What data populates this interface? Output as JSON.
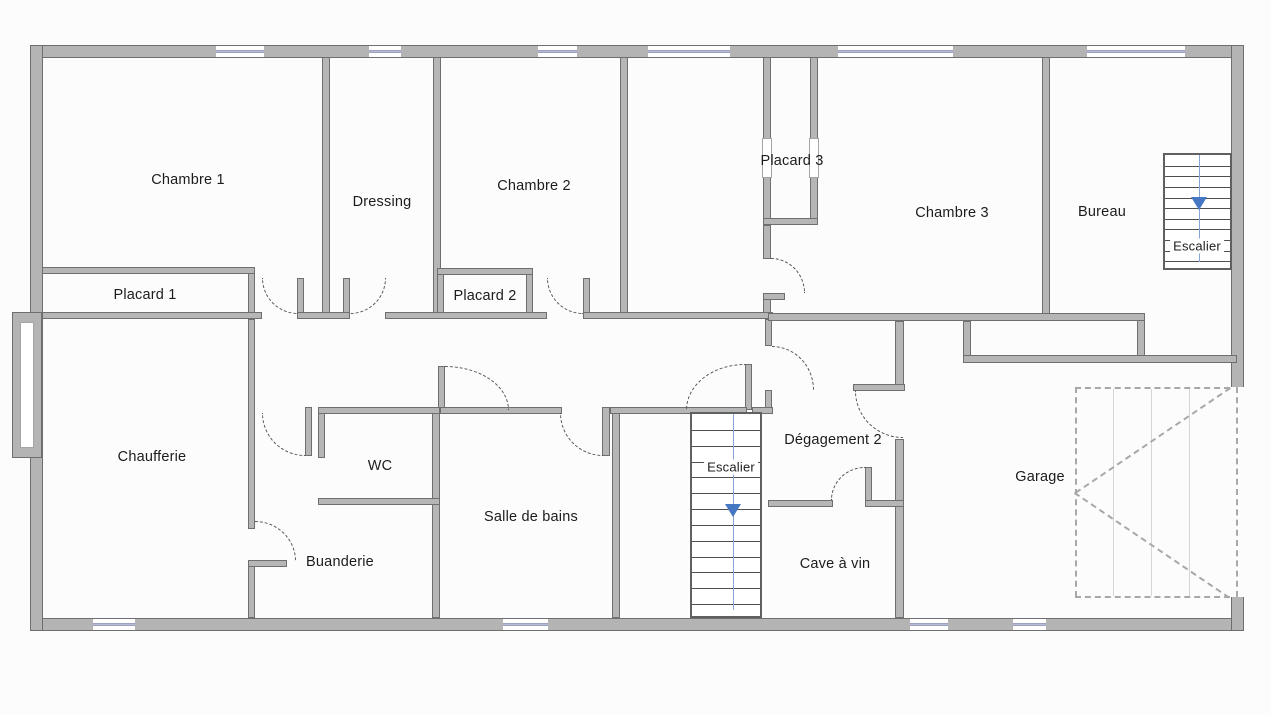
{
  "colors": {
    "wall_fill": "#b6b6b6",
    "wall_fill_outer": "#b4b4b4",
    "wall_edge": "#6f6f6f",
    "window_glass": "#b6bbd6",
    "stairs_accent": "#4577c2",
    "stairs_line": "#86a4d8",
    "door_arc": "#555555",
    "garage_dash": "#a8a8a8",
    "text": "#1c1c1c",
    "background": "#fcfcfc"
  },
  "rooms": [
    {
      "id": "chambre-1",
      "label": "Chambre 1"
    },
    {
      "id": "dressing",
      "label": "Dressing"
    },
    {
      "id": "chambre-2",
      "label": "Chambre 2"
    },
    {
      "id": "placard-3",
      "label": "Placard 3"
    },
    {
      "id": "chambre-3",
      "label": "Chambre 3"
    },
    {
      "id": "bureau",
      "label": "Bureau"
    },
    {
      "id": "escalier-haut",
      "label": "Escalier"
    },
    {
      "id": "placard-1",
      "label": "Placard 1"
    },
    {
      "id": "placard-2",
      "label": "Placard 2"
    },
    {
      "id": "chaufferie",
      "label": "Chaufferie"
    },
    {
      "id": "wc",
      "label": "WC"
    },
    {
      "id": "salle-de-bains",
      "label": "Salle de bains"
    },
    {
      "id": "escalier-milieu",
      "label": "Escalier"
    },
    {
      "id": "degagement-2",
      "label": "Dégagement 2"
    },
    {
      "id": "cave-a-vin",
      "label": "Cave à vin"
    },
    {
      "id": "garage",
      "label": "Garage"
    },
    {
      "id": "buanderie",
      "label": "Buanderie"
    }
  ]
}
